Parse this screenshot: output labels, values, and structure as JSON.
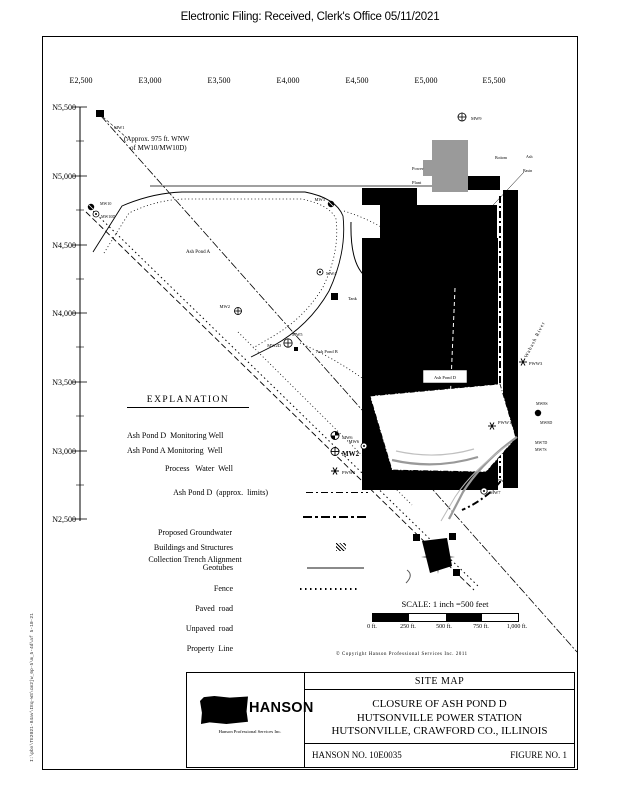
{
  "header": {
    "filing_notice": "Electronic Filing: Received, Clerk's Office 05/11/2021"
  },
  "grid": {
    "eastings": [
      "E2,500",
      "E3,000",
      "E3,500",
      "E4,000",
      "E4,500",
      "E5,000",
      "E5,500"
    ],
    "northings": [
      "N5,500",
      "N5,000",
      "N4,500",
      "N4,000",
      "N3,500",
      "N3,000",
      "N2,500"
    ]
  },
  "map": {
    "mw1_note_line1": "(Approx. 975 ft. WNW",
    "mw1_note_line2": "of MW10/MW10D)",
    "areas": {
      "pond_a": "Ash Pond A",
      "pond_b": "Ash Pond B",
      "pond_d": "Ash Pond D",
      "power_1": "Power",
      "power_2": "Plant",
      "bottom": "Bottom",
      "ash": "Ash",
      "basin": "Basin",
      "tank": "Tank",
      "river": "Wabash River"
    },
    "wells": [
      {
        "label": "MW1"
      },
      {
        "label": "MW9"
      },
      {
        "label": "MW10"
      },
      {
        "label": "MW10D"
      },
      {
        "label": "MW3"
      },
      {
        "label": "MW4"
      },
      {
        "label": "MW2"
      },
      {
        "label": "MW5"
      },
      {
        "label": "MW2D"
      },
      {
        "label": "MW6"
      },
      {
        "label": "MW7"
      },
      {
        "label": "PWW1"
      },
      {
        "label": "PWW2"
      },
      {
        "label": "PWW3"
      },
      {
        "label": "MW8S"
      },
      {
        "label": "MW8D"
      },
      {
        "label": "MW7D"
      },
      {
        "label": "MW7S"
      }
    ]
  },
  "legend": {
    "title": "EXPLANATION",
    "entries": [
      {
        "label": "Ash Pond D  Monitoring Well",
        "symbol_label": "MW6"
      },
      {
        "label": "Ash Pond A Monitoring  Well",
        "symbol_label": "MW2"
      },
      {
        "label": "Process   Water  Well",
        "symbol_label": "PWW2"
      },
      {
        "label": "Ash Pond D  (approx.  limits)"
      },
      {
        "label": "Proposed Groundwater",
        "label2": "Collection Trench Alignment"
      },
      {
        "label": "Buildings and Structures"
      },
      {
        "label": "Geotubes"
      },
      {
        "label": "Fence"
      },
      {
        "label": "Paved  road"
      },
      {
        "label": "Unpaved  road"
      },
      {
        "label": "Property  Line"
      }
    ]
  },
  "scale": {
    "title": "SCALE: 1 inch =500  feet",
    "ticks": [
      "0 ft.",
      "250 ft.",
      "500 ft.",
      "750 ft.",
      "1,000 ft."
    ]
  },
  "copyright": "©  Copyright  Hanson  Professional  Services  Inc.   2011",
  "title_block": {
    "site_map": "SITE MAP",
    "line1": "CLOSURE OF ASH POND D",
    "line2": "HUTSONVILLE POWER STATION",
    "line3": "HUTSONVILLE, CRAWFORD CO.,  ILLINOIS",
    "project_no": "HANSON NO. 10E0035",
    "figure_no": "FIGURE NO. 1",
    "logo_text": "HANSON",
    "logo_subtext": "Hanson Professional Services Inc."
  },
  "plot_stamp": "I:\\pbx\\TE2021-84av\\IEq-WS\\cm2jw_6p-5\\m_5-4d\\af  5-10-21"
}
